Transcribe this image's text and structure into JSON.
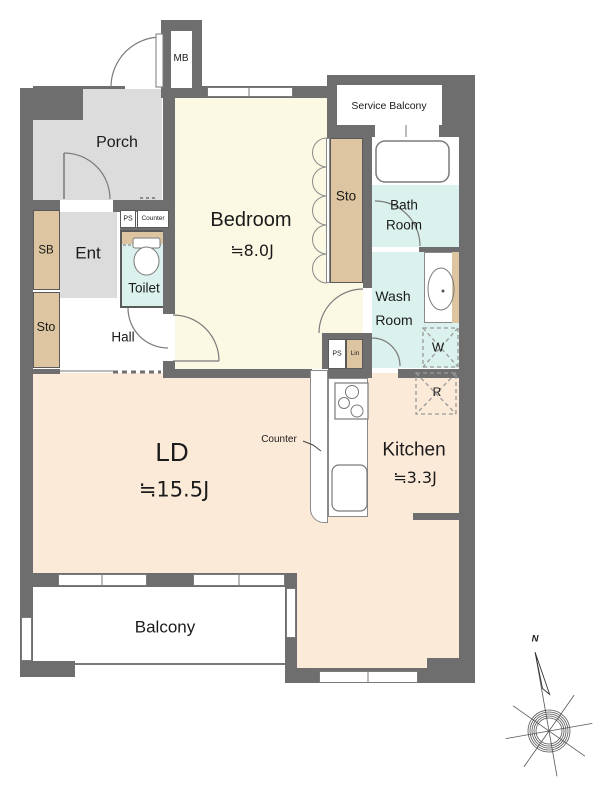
{
  "rooms": {
    "porch": {
      "label": "Porch"
    },
    "entrance": {
      "label": "Ent"
    },
    "hall": {
      "label": "Hall"
    },
    "toilet": {
      "label": "Toilet"
    },
    "bedroom": {
      "label": "Bedroom",
      "size": "≒8.0J"
    },
    "living_dining": {
      "label": "LD",
      "size": "≒15.5J"
    },
    "kitchen": {
      "label": "Kitchen",
      "size": "≒3.3J"
    },
    "bathroom": {
      "line1": "Bath",
      "line2": "Room"
    },
    "washroom": {
      "line1": "Wash",
      "line2": "Room"
    },
    "balcony": {
      "label": "Balcony"
    },
    "service_balcony": {
      "label": "Service Balcony"
    }
  },
  "storage": {
    "shoe_box": "SB",
    "hall_storage": "Sto",
    "bedroom_closet": "Sto",
    "linen": "Lin"
  },
  "equipment": {
    "meter_box": "MB",
    "pipe_space_entry": "PS",
    "entry_counter": "Counter",
    "pipe_space_bedroom": "PS",
    "washer_space": "W",
    "refrigerator_space": "R",
    "kitchen_counter": "Counter"
  },
  "compass": {
    "north": "N"
  },
  "colors": {
    "wall": "#6e6e6e",
    "bedroom_floor": "#fbf9e3",
    "living_floor": "#fcead9",
    "wet_area": "#daf1ee",
    "storage_tan": "#dcc5a0",
    "porch_gray": "#dcdcdc"
  }
}
